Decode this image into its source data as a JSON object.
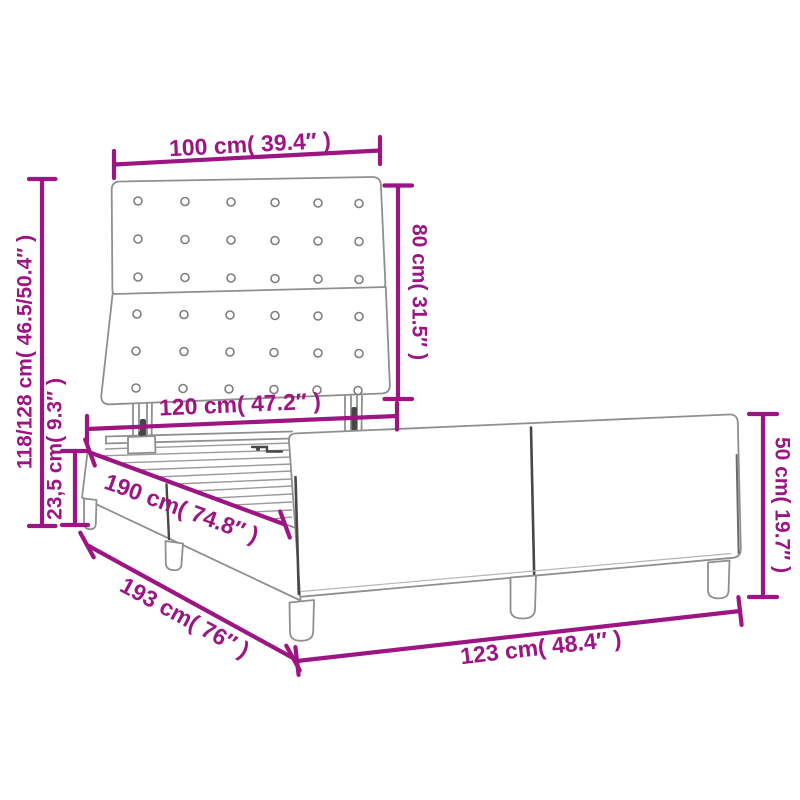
{
  "page": {
    "title": "Bed frame dimension diagram",
    "background": "#ffffff"
  },
  "colors": {
    "accent": "#9C1583",
    "line": "#8F8F8F",
    "dark_detail": "#474747"
  },
  "diagram": {
    "product": "upholstered bed frame with button-tufted headboard",
    "style": "perspective line drawing with dimension callouts",
    "headboard": {
      "panels": 2,
      "button_rows": 6,
      "button_columns": 6
    },
    "dimensions": [
      {
        "id": "headboard_width",
        "label": "100 cm( 39.4″ )",
        "cm": "100",
        "inches": "39.4"
      },
      {
        "id": "headboard_height",
        "label": "80 cm( 31.5″ )",
        "cm": "80",
        "inches": "31.5"
      },
      {
        "id": "overall_height",
        "label": "118/128 cm( 46.5/50.4″ )",
        "cm": "118/128",
        "inches": "46.5/50.4"
      },
      {
        "id": "base_height",
        "label": "23,5 cm( 9.3″ )",
        "cm": "23,5",
        "inches": "9.3"
      },
      {
        "id": "inner_width",
        "label": "120 cm( 47.2″ )",
        "cm": "120",
        "inches": "47.2"
      },
      {
        "id": "inner_length",
        "label": "190 cm( 74.8″ )",
        "cm": "190",
        "inches": "74.8"
      },
      {
        "id": "outer_length",
        "label": "193 cm( 76″ )",
        "cm": "193",
        "inches": "76"
      },
      {
        "id": "outer_width",
        "label": "123 cm( 48.4″ )",
        "cm": "123",
        "inches": "48.4"
      },
      {
        "id": "footboard_height",
        "label": "50 cm( 19.7″ )",
        "cm": "50",
        "inches": "19.7"
      }
    ]
  }
}
